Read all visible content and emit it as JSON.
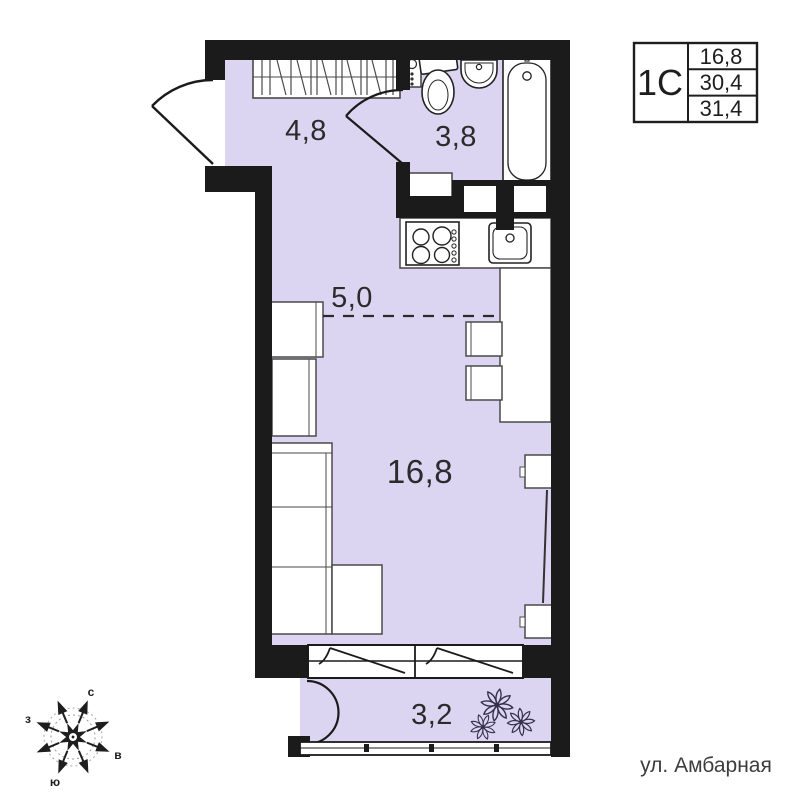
{
  "unit_card": {
    "type": "1С",
    "values": [
      "16,8",
      "30,4",
      "31,4"
    ]
  },
  "rooms": {
    "hall": "4,8",
    "bathroom": "3,8",
    "kitchen": "5,0",
    "living": "16,8",
    "balcony": "3,2"
  },
  "compass": {
    "north": "с",
    "east": "в",
    "south": "ю",
    "west": "з"
  },
  "street": "ул. Амбарная",
  "colors": {
    "floor": "#dcd5f2",
    "wall": "#1b1b1b"
  }
}
